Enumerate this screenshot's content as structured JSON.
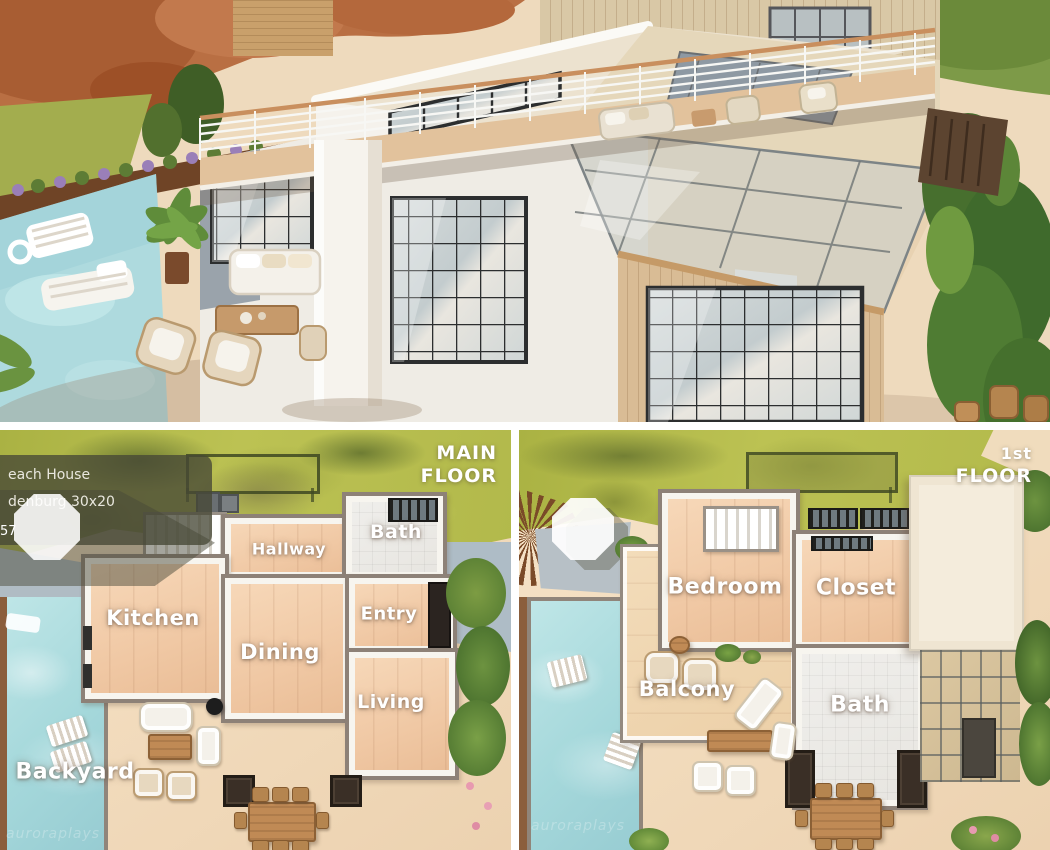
{
  "collage": {
    "top_view": {
      "scene": "modern beach house 3d exterior",
      "objects": [
        "autumn-tree",
        "balcony-deck-railing",
        "white-tower",
        "grid-windows",
        "wood-wing",
        "glass-roof",
        "pool",
        "pool-floats",
        "patio-sofa-set",
        "palm-plant",
        "cypress-trees"
      ]
    },
    "main_floor_panel": {
      "info_box": {
        "line1": "each House",
        "line2": "denburg 30x20",
        "line3": "57"
      },
      "floor_tag": {
        "line1": "MAIN",
        "line2": "FLOOR"
      },
      "rooms": [
        {
          "label": "Kitchen"
        },
        {
          "label": "Dining"
        },
        {
          "label": "Hallway"
        },
        {
          "label": "Bath"
        },
        {
          "label": "Entry"
        },
        {
          "label": "Living"
        }
      ],
      "outdoor_label": "Backyard",
      "watermark": "auroraplays"
    },
    "first_floor_panel": {
      "floor_tag": {
        "line1": "1st",
        "line2": "FLOOR"
      },
      "rooms": [
        {
          "label": "Bedroom"
        },
        {
          "label": "Closet"
        },
        {
          "label": "Balcony"
        },
        {
          "label": "Bath"
        }
      ],
      "watermark": "auroraplays"
    }
  },
  "palette": {
    "sand": "#f3dfc3",
    "lawn_green": "#b5bb50",
    "pool_blue": "#a9dadd",
    "wood_floor": "#f2cfae",
    "wall_gray": "#8d8177",
    "tile_white": "#e9e7e3",
    "autumn_tree": "#b96f43",
    "cypress_green": "#4a7230",
    "label_text": "#ffffff"
  }
}
